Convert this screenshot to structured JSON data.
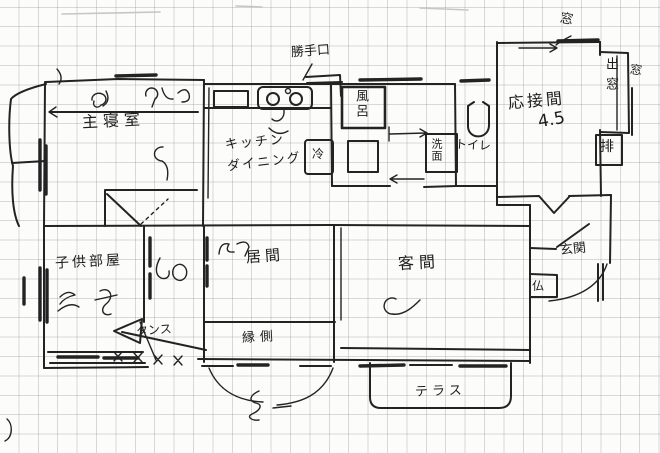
{
  "colors": {
    "ink": "#232323",
    "paper": "#fcfcfa",
    "grid": "#8d93a0"
  },
  "rooms": {
    "master_bedroom": {
      "label": "主寝室"
    },
    "kitchen_dining": {
      "label_line1": "キッチン",
      "label_line2": "ダイニング"
    },
    "children_room": {
      "label": "子供部屋"
    },
    "living_room": {
      "label": "居間"
    },
    "guest_room": {
      "label": "客間"
    },
    "reception_room": {
      "label": "応接間",
      "size_tatami": "4.5"
    },
    "entrance": {
      "label": "玄関"
    },
    "toilet": {
      "label": "トイレ"
    },
    "veranda": {
      "label": "縁側"
    },
    "terrace": {
      "label": "テラス"
    }
  },
  "fixtures": {
    "bath": "風呂",
    "washstand": "洗面",
    "fridge": "冷",
    "wardrobe": "タンス",
    "altar": "仏",
    "vent": "排"
  },
  "openings": {
    "back_door": "勝手口",
    "window_top": "窓",
    "bay_window": "出窓",
    "window_right": "窓"
  }
}
